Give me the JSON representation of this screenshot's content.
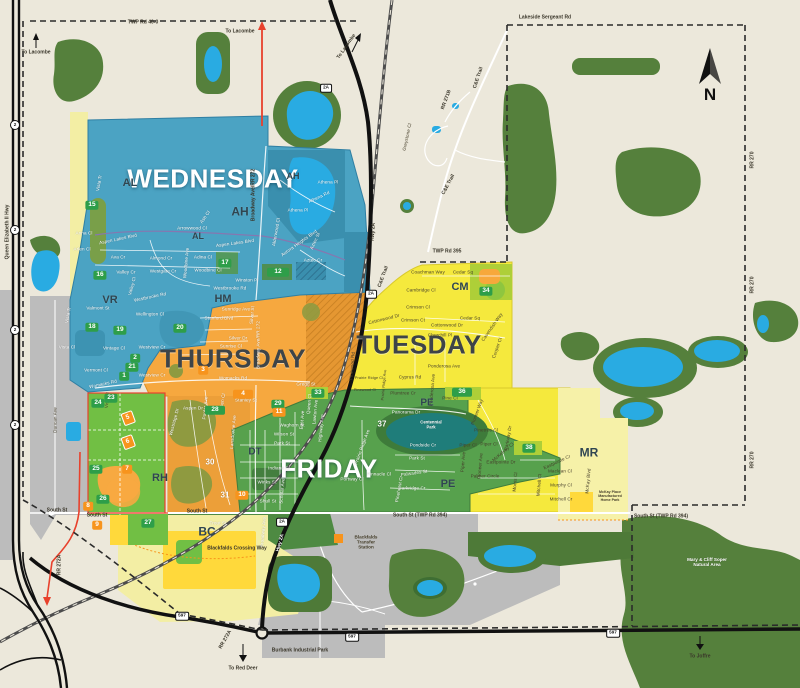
{
  "colors": {
    "background": "#ECE8DB",
    "wednesday_blue": "#4BA3C3",
    "thursday_orange": "#F6A83F",
    "tuesday_yellow": "#F5E93D",
    "friday_green": "#57A14D",
    "forest_green": "#55803C",
    "water_blue": "#29ABE2",
    "urban_gray": "#BCBCBC",
    "badge_green": "#2E9E49",
    "badge_orange": "#F7941D",
    "boundary_red": "#E8412C",
    "road_black": "#111111"
  },
  "north": {
    "label": "N"
  },
  "zone_titles": [
    {
      "text": "WEDNESDAY",
      "x": 213,
      "y": 179,
      "theme": "light"
    },
    {
      "text": "THURSDAY",
      "x": 233,
      "y": 359,
      "theme": "dark"
    },
    {
      "text": "TUESDAY",
      "x": 419,
      "y": 345,
      "theme": "dark"
    },
    {
      "text": "FRIDAY",
      "x": 329,
      "y": 469,
      "theme": "light"
    }
  ],
  "area_codes": [
    {
      "text": "AL",
      "x": 130,
      "y": 183,
      "s": 11
    },
    {
      "text": "AH",
      "x": 240,
      "y": 212,
      "s": 12
    },
    {
      "text": "AH",
      "x": 293,
      "y": 177,
      "s": 9
    },
    {
      "text": "AL",
      "x": 198,
      "y": 237,
      "s": 9
    },
    {
      "text": "VR",
      "x": 110,
      "y": 300,
      "s": 11
    },
    {
      "text": "HM",
      "x": 223,
      "y": 299,
      "s": 11
    },
    {
      "text": "CM",
      "x": 460,
      "y": 287,
      "s": 11
    },
    {
      "text": "PE",
      "x": 427,
      "y": 403,
      "s": 10
    },
    {
      "text": "PE",
      "x": 448,
      "y": 484,
      "s": 11
    },
    {
      "text": "DT",
      "x": 255,
      "y": 452,
      "s": 10
    },
    {
      "text": "RH",
      "x": 160,
      "y": 478,
      "s": 11
    },
    {
      "text": "BC",
      "x": 207,
      "y": 532,
      "s": 12
    },
    {
      "text": "MR",
      "x": 589,
      "y": 453,
      "s": 12
    }
  ],
  "green_badges": [
    {
      "text": "15",
      "x": 92,
      "y": 205
    },
    {
      "text": "16",
      "x": 100,
      "y": 275
    },
    {
      "text": "17",
      "x": 225,
      "y": 263
    },
    {
      "text": "12",
      "x": 278,
      "y": 272,
      "w": 16
    },
    {
      "text": "18",
      "x": 92,
      "y": 327
    },
    {
      "text": "19",
      "x": 120,
      "y": 330
    },
    {
      "text": "20",
      "x": 180,
      "y": 328
    },
    {
      "text": "2",
      "x": 135,
      "y": 358
    },
    {
      "text": "21",
      "x": 132,
      "y": 367
    },
    {
      "text": "1",
      "x": 124,
      "y": 376
    },
    {
      "text": "23",
      "x": 111,
      "y": 398
    },
    {
      "text": "24",
      "x": 98,
      "y": 403
    },
    {
      "text": "25",
      "x": 96,
      "y": 469
    },
    {
      "text": "26",
      "x": 103,
      "y": 499
    },
    {
      "text": "27",
      "x": 148,
      "y": 523
    },
    {
      "text": "28",
      "x": 215,
      "y": 410,
      "w": 14
    },
    {
      "text": "29",
      "x": 278,
      "y": 404
    },
    {
      "text": "33",
      "x": 318,
      "y": 393
    },
    {
      "text": "34",
      "x": 486,
      "y": 291
    },
    {
      "text": "36",
      "x": 462,
      "y": 392,
      "w": 14
    },
    {
      "text": "38",
      "x": 529,
      "y": 448
    }
  ],
  "orange_badges": [
    {
      "text": "3",
      "x": 203,
      "y": 370
    },
    {
      "text": "4",
      "x": 243,
      "y": 394,
      "w": 14
    },
    {
      "text": "5",
      "x": 128,
      "y": 418,
      "r": -20,
      "d": 1
    },
    {
      "text": "6",
      "x": 128,
      "y": 442,
      "r": -20,
      "d": 1
    },
    {
      "text": "7",
      "x": 127,
      "y": 469
    },
    {
      "text": "8",
      "x": 88,
      "y": 506
    },
    {
      "text": "9",
      "x": 97,
      "y": 525
    },
    {
      "text": "10",
      "x": 242,
      "y": 495
    },
    {
      "text": "11",
      "x": 279,
      "y": 412
    }
  ],
  "white_numbers": [
    {
      "text": "30",
      "x": 210,
      "y": 462
    },
    {
      "text": "31",
      "x": 225,
      "y": 495
    },
    {
      "text": "37",
      "x": 382,
      "y": 424
    }
  ],
  "shields": [
    {
      "text": "2",
      "x": 15,
      "y": 125,
      "c": 1
    },
    {
      "text": "2",
      "x": 15,
      "y": 230,
      "c": 1
    },
    {
      "text": "2",
      "x": 15,
      "y": 330,
      "c": 1
    },
    {
      "text": "2",
      "x": 15,
      "y": 425,
      "c": 1
    },
    {
      "text": "2A",
      "x": 326,
      "y": 88
    },
    {
      "text": "2A",
      "x": 371,
      "y": 294
    },
    {
      "text": "2A",
      "x": 282,
      "y": 522
    },
    {
      "text": "597",
      "x": 182,
      "y": 616
    },
    {
      "text": "597",
      "x": 352,
      "y": 637
    },
    {
      "text": "597",
      "x": 613,
      "y": 633
    }
  ],
  "road_labels": [
    {
      "text": "TWP Rd 40-0",
      "x": 143,
      "y": 23
    },
    {
      "text": "Lakeside Sergeant Rd",
      "x": 545,
      "y": 18
    },
    {
      "text": "TWP Rd 395",
      "x": 447,
      "y": 252
    },
    {
      "text": "South St",
      "x": 57,
      "y": 511
    },
    {
      "text": "South St",
      "x": 97,
      "y": 516
    },
    {
      "text": "South St",
      "x": 197,
      "y": 512
    },
    {
      "text": "South St (TWP Rd 394)",
      "x": 420,
      "y": 516
    },
    {
      "text": "South St (TWP Rd 394)",
      "x": 661,
      "y": 517
    },
    {
      "text": "RR 270",
      "x": 753,
      "y": 160,
      "r": -90
    },
    {
      "text": "RR 270",
      "x": 753,
      "y": 285,
      "r": -90
    },
    {
      "text": "RR 270",
      "x": 753,
      "y": 460,
      "r": -90
    },
    {
      "text": "RR 272A",
      "x": 60,
      "y": 565,
      "r": -90
    },
    {
      "text": "RR 272A",
      "x": 226,
      "y": 640,
      "r": -60
    },
    {
      "text": "RR 271B",
      "x": 447,
      "y": 100,
      "r": -70
    },
    {
      "text": "C&E Trail",
      "x": 479,
      "y": 78,
      "r": -72
    },
    {
      "text": "C&E Trail",
      "x": 449,
      "y": 185,
      "r": -62
    },
    {
      "text": "C&E Trail",
      "x": 384,
      "y": 277,
      "r": -70
    },
    {
      "text": "Broadway Ave/RR 272",
      "x": 254,
      "y": 195,
      "r": -90
    },
    {
      "text": "Queen Elizabeth II Hwy",
      "x": 8,
      "y": 232,
      "r": -90
    },
    {
      "text": "Hwy 2A",
      "x": 374,
      "y": 232,
      "r": -86
    },
    {
      "text": "Hwy 2A",
      "x": 281,
      "y": 543,
      "r": -75,
      "t": "w"
    },
    {
      "text": "To Lacombe",
      "x": 36,
      "y": 53
    },
    {
      "text": "To Lacombe",
      "x": 240,
      "y": 32
    },
    {
      "text": "To Lacombe",
      "x": 347,
      "y": 47,
      "r": -55
    },
    {
      "text": "To Red Deer",
      "x": 243,
      "y": 669
    },
    {
      "text": "To Joffre",
      "x": 700,
      "y": 657
    },
    {
      "text": "Blackfalds Crossing Way",
      "x": 237,
      "y": 549
    },
    {
      "text": "Burbank Industrial Park",
      "x": 300,
      "y": 651
    }
  ],
  "place_labels": [
    {
      "text": "Blackfalds\nTransfer\nStation",
      "x": 366,
      "y": 542,
      "t": "d"
    },
    {
      "text": "Mary & Cliff Soper\nNatural Area",
      "x": 707,
      "y": 562,
      "t": "w"
    },
    {
      "text": "McKay Place\nManufactured\nHome Park",
      "x": 610,
      "y": 497,
      "t": "d",
      "s": 3.6
    },
    {
      "text": "Centennial\nPark",
      "x": 431,
      "y": 425,
      "t": "w",
      "s": 4.2
    }
  ],
  "street_labels": [
    {
      "text": "Vista Tr",
      "x": 99,
      "y": 183,
      "r": -80,
      "t": "w"
    },
    {
      "text": "Anna Cl",
      "x": 84,
      "y": 233,
      "t": "w"
    },
    {
      "text": "Aspen Lakes Blvd",
      "x": 118,
      "y": 239,
      "r": -12,
      "t": "w"
    },
    {
      "text": "Arlen Cl",
      "x": 82,
      "y": 249,
      "t": "w"
    },
    {
      "text": "Ava Cr",
      "x": 118,
      "y": 257,
      "t": "w"
    },
    {
      "text": "Valley Cr",
      "x": 126,
      "y": 272,
      "t": "w"
    },
    {
      "text": "Westgate Cr",
      "x": 163,
      "y": 271,
      "t": "w"
    },
    {
      "text": "Almond Cr",
      "x": 161,
      "y": 258,
      "t": "w"
    },
    {
      "text": "Adina Cl",
      "x": 203,
      "y": 257,
      "t": "w"
    },
    {
      "text": "Woodbine Cl",
      "x": 208,
      "y": 270,
      "t": "w"
    },
    {
      "text": "Arrowwood Cl",
      "x": 192,
      "y": 228,
      "t": "w"
    },
    {
      "text": "Ash Cl",
      "x": 205,
      "y": 217,
      "r": -55,
      "t": "w"
    },
    {
      "text": "Aspen Lakes Blvd",
      "x": 235,
      "y": 243,
      "r": -8,
      "t": "w"
    },
    {
      "text": "Winston Pl",
      "x": 247,
      "y": 280,
      "t": "w"
    },
    {
      "text": "Westbrooke Rd",
      "x": 230,
      "y": 288,
      "t": "w"
    },
    {
      "text": "Westbrooke Rd",
      "x": 150,
      "y": 297,
      "r": -12,
      "t": "w"
    },
    {
      "text": "Athena Pl",
      "x": 328,
      "y": 182,
      "t": "w"
    },
    {
      "text": "Athena Rd",
      "x": 319,
      "y": 197,
      "r": -25,
      "t": "w"
    },
    {
      "text": "Athena Pl",
      "x": 298,
      "y": 210,
      "t": "w"
    },
    {
      "text": "Alderwood Cl",
      "x": 276,
      "y": 232,
      "r": -80,
      "t": "w"
    },
    {
      "text": "Aurora Heights Blvd",
      "x": 299,
      "y": 243,
      "r": -35,
      "t": "w"
    },
    {
      "text": "Aztec St",
      "x": 315,
      "y": 241,
      "r": -65,
      "t": "w"
    },
    {
      "text": "Aztec Cr",
      "x": 313,
      "y": 260,
      "t": "w"
    },
    {
      "text": "Woodbine Ave",
      "x": 186,
      "y": 263,
      "r": -85,
      "t": "w"
    },
    {
      "text": "Valmont St",
      "x": 98,
      "y": 308,
      "t": "w"
    },
    {
      "text": "Vista Tr",
      "x": 68,
      "y": 315,
      "r": -80,
      "t": "w"
    },
    {
      "text": "Valley Cl",
      "x": 132,
      "y": 286,
      "r": -75,
      "t": "w"
    },
    {
      "text": "Vintage Cl",
      "x": 114,
      "y": 348,
      "t": "w"
    },
    {
      "text": "Vista Cl",
      "x": 67,
      "y": 347,
      "t": "w"
    },
    {
      "text": "Vermont Cl",
      "x": 96,
      "y": 370,
      "t": "w"
    },
    {
      "text": "Wellington Cl",
      "x": 150,
      "y": 314,
      "t": "w"
    },
    {
      "text": "Sunridge Ave",
      "x": 236,
      "y": 309,
      "t": "w"
    },
    {
      "text": "Stanford Blvd",
      "x": 219,
      "y": 318,
      "t": "w"
    },
    {
      "text": "Silver Dr",
      "x": 238,
      "y": 338,
      "t": "w"
    },
    {
      "text": "Silver St",
      "x": 252,
      "y": 315,
      "r": -85,
      "t": "w"
    },
    {
      "text": "Sunrise Cl",
      "x": 231,
      "y": 346,
      "t": "w"
    },
    {
      "text": "Westview Cr",
      "x": 152,
      "y": 347,
      "t": "w"
    },
    {
      "text": "Westview Cr",
      "x": 152,
      "y": 375,
      "t": "w"
    },
    {
      "text": "Womacks Rd",
      "x": 233,
      "y": 378,
      "t": "w"
    },
    {
      "text": "Womacks Rd",
      "x": 103,
      "y": 384,
      "r": -12,
      "t": "w"
    },
    {
      "text": "Gregg St",
      "x": 306,
      "y": 384,
      "t": "w"
    },
    {
      "text": "Stanley St",
      "x": 246,
      "y": 400,
      "t": "w"
    },
    {
      "text": "Aspen Dr",
      "x": 193,
      "y": 408,
      "t": "w"
    },
    {
      "text": "Poplar Ave",
      "x": 205,
      "y": 408,
      "r": -85,
      "t": "w"
    },
    {
      "text": "Aspen Cl",
      "x": 222,
      "y": 403,
      "r": -80,
      "t": "w"
    },
    {
      "text": "Lansdowne Ave",
      "x": 233,
      "y": 432,
      "r": -85,
      "t": "w"
    },
    {
      "text": "Westridge Dr",
      "x": 174,
      "y": 422,
      "r": -75,
      "t": "w"
    },
    {
      "text": "Broadway Ave/RR 272",
      "x": 258,
      "y": 345,
      "r": -90,
      "t": "w"
    },
    {
      "text": "Waghorn St",
      "x": 292,
      "y": 425,
      "t": "w"
    },
    {
      "text": "Wilson St",
      "x": 284,
      "y": 434,
      "t": "w"
    },
    {
      "text": "Park St",
      "x": 282,
      "y": 443,
      "t": "w"
    },
    {
      "text": "East Ave",
      "x": 302,
      "y": 420,
      "r": -85,
      "t": "w"
    },
    {
      "text": "Queen Cl",
      "x": 309,
      "y": 404,
      "r": -85,
      "t": "w"
    },
    {
      "text": "Lawton Ave",
      "x": 315,
      "y": 412,
      "r": -85,
      "t": "w"
    },
    {
      "text": "Highway Ave",
      "x": 321,
      "y": 428,
      "r": -85,
      "t": "w"
    },
    {
      "text": "Indiana St",
      "x": 279,
      "y": 468,
      "t": "w"
    },
    {
      "text": "Winks St",
      "x": 267,
      "y": 482,
      "t": "w"
    },
    {
      "text": "Schular Ave",
      "x": 282,
      "y": 491,
      "r": -85,
      "t": "w"
    },
    {
      "text": "Shull St",
      "x": 268,
      "y": 501,
      "t": "w"
    },
    {
      "text": "Broadway Ave",
      "x": 263,
      "y": 532,
      "r": -85,
      "t": "w"
    },
    {
      "text": "Trout St",
      "x": 218,
      "y": 523,
      "t": "w"
    },
    {
      "text": "Panorama Dr",
      "x": 406,
      "y": 412,
      "t": "w"
    },
    {
      "text": "Pondside Cr",
      "x": 423,
      "y": 445,
      "t": "w"
    },
    {
      "text": "Park St",
      "x": 417,
      "y": 458,
      "t": "w"
    },
    {
      "text": "Palisades St",
      "x": 414,
      "y": 473,
      "r": -8,
      "t": "w"
    },
    {
      "text": "Parkridge Cr",
      "x": 412,
      "y": 488,
      "t": "w"
    },
    {
      "text": "Pinnacle Cl",
      "x": 379,
      "y": 474,
      "t": "w"
    },
    {
      "text": "Portway Cl",
      "x": 352,
      "y": 479,
      "t": "w"
    },
    {
      "text": "Pinehurst Cr",
      "x": 399,
      "y": 489,
      "r": -80,
      "t": "w"
    },
    {
      "text": "Prairie Ridge Ave",
      "x": 362,
      "y": 447,
      "r": -70,
      "t": "w"
    },
    {
      "text": "Coachman Way",
      "x": 428,
      "y": 272,
      "t": "d"
    },
    {
      "text": "Cedar Sq",
      "x": 463,
      "y": 272,
      "t": "d"
    },
    {
      "text": "Cedar Sq",
      "x": 470,
      "y": 318,
      "t": "d"
    },
    {
      "text": "Cambridge Cl",
      "x": 421,
      "y": 290,
      "t": "d"
    },
    {
      "text": "Crimson Cl",
      "x": 418,
      "y": 307,
      "t": "d"
    },
    {
      "text": "Crimson Ct",
      "x": 413,
      "y": 320,
      "t": "d"
    },
    {
      "text": "Cottonwood Dr",
      "x": 384,
      "y": 319,
      "r": -14,
      "t": "d"
    },
    {
      "text": "Cottonwood Dr",
      "x": 447,
      "y": 325,
      "t": "d"
    },
    {
      "text": "Churchill Pl",
      "x": 440,
      "y": 335,
      "t": "d"
    },
    {
      "text": "Cavendish Way",
      "x": 492,
      "y": 327,
      "r": -55,
      "t": "d"
    },
    {
      "text": "Cooper Cl",
      "x": 497,
      "y": 348,
      "r": -70,
      "t": "d"
    },
    {
      "text": "Ponderosa Ave",
      "x": 444,
      "y": 366,
      "t": "d"
    },
    {
      "text": "Ponderosa Ave",
      "x": 432,
      "y": 390,
      "r": -85,
      "t": "d"
    },
    {
      "text": "Cyprus Rd",
      "x": 410,
      "y": 377,
      "t": "d"
    },
    {
      "text": "Plumtree Cr",
      "x": 403,
      "y": 393,
      "t": "d"
    },
    {
      "text": "Pine Cl",
      "x": 450,
      "y": 398,
      "t": "d"
    },
    {
      "text": "Prairie Ridge Cl",
      "x": 369,
      "y": 378,
      "t": "d",
      "s": 3.8
    },
    {
      "text": "Pinewood Cl",
      "x": 365,
      "y": 390,
      "t": "d",
      "s": 3.8
    },
    {
      "text": "Pinewood Rd",
      "x": 352,
      "y": 366,
      "r": -85,
      "t": "d"
    },
    {
      "text": "Prairie Ridge Ave",
      "x": 384,
      "y": 385,
      "r": -85,
      "t": "d",
      "s": 3.8
    },
    {
      "text": "Pioneer Way",
      "x": 477,
      "y": 412,
      "r": -70,
      "t": "d"
    },
    {
      "text": "Pinetree Cl",
      "x": 486,
      "y": 430,
      "t": "d"
    },
    {
      "text": "Piper Cl",
      "x": 489,
      "y": 444,
      "t": "d"
    },
    {
      "text": "Pioneer Ave",
      "x": 480,
      "y": 466,
      "r": -85,
      "t": "d"
    },
    {
      "text": "Parkway Dr",
      "x": 508,
      "y": 438,
      "r": -80,
      "t": "d"
    },
    {
      "text": "McKelvey Cl",
      "x": 503,
      "y": 452,
      "r": -40,
      "t": "d"
    },
    {
      "text": "Eastpointe Dr",
      "x": 501,
      "y": 462,
      "t": "d"
    },
    {
      "text": "Palmer Circle",
      "x": 485,
      "y": 476,
      "t": "d"
    },
    {
      "text": "Morris Cl",
      "x": 515,
      "y": 482,
      "r": -85,
      "t": "d"
    },
    {
      "text": "Mitchell Cl",
      "x": 539,
      "y": 485,
      "r": -85,
      "t": "d"
    },
    {
      "text": "Eastpointe Cr",
      "x": 557,
      "y": 462,
      "r": -25,
      "t": "d"
    },
    {
      "text": "Maclean Cl",
      "x": 560,
      "y": 471,
      "t": "d"
    },
    {
      "text": "Murphy Cl",
      "x": 561,
      "y": 485,
      "t": "d"
    },
    {
      "text": "Mitchell Cr",
      "x": 561,
      "y": 499,
      "t": "d"
    },
    {
      "text": "McKay Blvd",
      "x": 588,
      "y": 481,
      "r": -85,
      "t": "d"
    },
    {
      "text": "Piper Cl",
      "x": 468,
      "y": 445,
      "t": "d"
    },
    {
      "text": "Piper Ave",
      "x": 463,
      "y": 462,
      "r": -85,
      "t": "d"
    },
    {
      "text": "Greystone Cl",
      "x": 407,
      "y": 137,
      "r": -78,
      "t": "d"
    },
    {
      "text": "Duncan Ave",
      "x": 55,
      "y": 420,
      "r": -90,
      "t": "d"
    },
    {
      "text": "Vista Tr",
      "x": 107,
      "y": 400,
      "r": -85,
      "t": "d"
    }
  ]
}
